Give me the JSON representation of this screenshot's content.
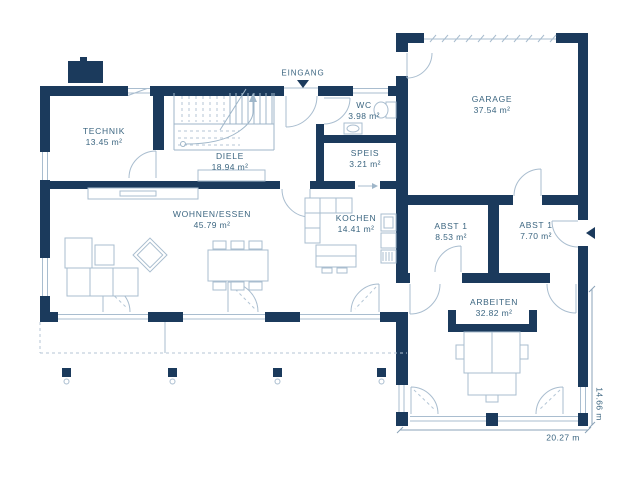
{
  "plan": {
    "entrance_label": "EINGANG",
    "rooms": [
      {
        "name": "TECHNIK",
        "area": "13.45 m²"
      },
      {
        "name": "DIELE",
        "area": "18.94 m²"
      },
      {
        "name": "WC",
        "area": "3.98 m²"
      },
      {
        "name": "SPEIS",
        "area": "3.21 m²"
      },
      {
        "name": "GARAGE",
        "area": "37.54 m²"
      },
      {
        "name": "WOHNEN/ESSEN",
        "area": "45.79 m²"
      },
      {
        "name": "KOCHEN",
        "area": "14.41 m²"
      },
      {
        "name": "ABST 1",
        "area": "8.53 m²"
      },
      {
        "name": "ABST 1",
        "area": "7.70 m²"
      },
      {
        "name": "ARBEITEN",
        "area": "32.82 m²"
      }
    ],
    "dimensions": {
      "width": "20.27 m",
      "depth": "14.66 m"
    },
    "colors": {
      "wall": "#1b3a5c",
      "line": "#a9bdcf",
      "stairs": "#9fb6c9",
      "dashed": "#b4c6d6",
      "dimension": "#8ba3b8",
      "text": "#3c6681",
      "background": "#ffffff"
    }
  }
}
